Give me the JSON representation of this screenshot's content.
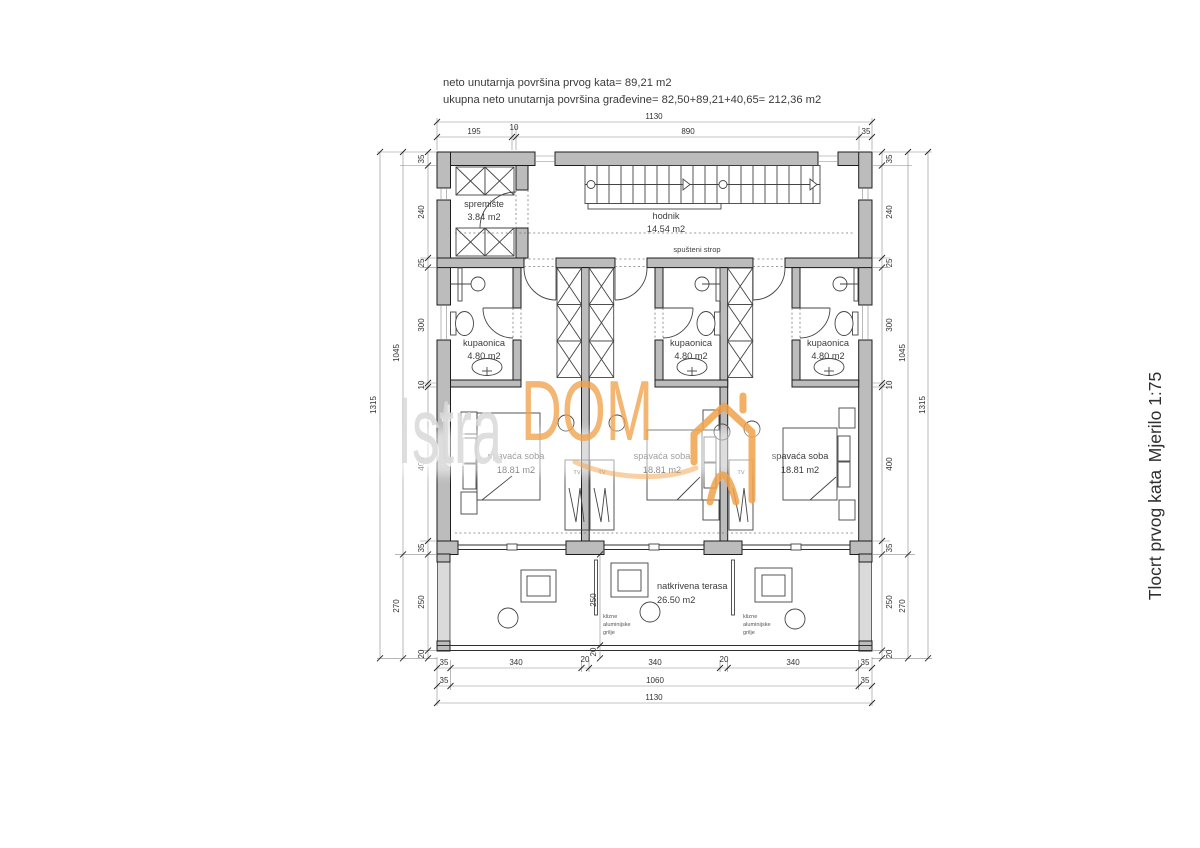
{
  "header": {
    "line1": "neto unutarnja površina prvog kata= 89,21 m2",
    "line2": "ukupna neto unutarnja površina građevine= 82,50+89,21+40,65= 212,36 m2"
  },
  "side": {
    "title": "Tlocrt prvog kata",
    "scale": "Mjerilo 1:75"
  },
  "watermark": {
    "brand1": "Istra",
    "brand2": "DOM"
  },
  "rooms": {
    "spremiste": {
      "name": "spremište",
      "area": "3.84 m2"
    },
    "hodnik": {
      "name": "hodnik",
      "area": "14.54 m2"
    },
    "kupaonica": {
      "name": "kupaonica",
      "area": "4.80 m2"
    },
    "spavaca": {
      "name": "spavaća soba",
      "area": "18.81 m2"
    },
    "terasa": {
      "name": "natkrivena terasa",
      "area": "26.50 m2"
    }
  },
  "notes": {
    "strop": "spušteni strop",
    "grilje": [
      "klizne",
      "aluminijske",
      "grilje"
    ],
    "tv": "TV"
  },
  "dims": {
    "top_total": "1130",
    "top_chain": [
      "195",
      "10",
      "890",
      "35"
    ],
    "bottom_chain": [
      "35",
      "340",
      "20",
      "340",
      "20",
      "340",
      "35"
    ],
    "bottom_mid": [
      "35",
      "1060",
      "35"
    ],
    "bottom_total": "1130",
    "side_chain": [
      "35",
      "240",
      "25",
      "300",
      "10",
      "400",
      "35",
      "250",
      "20"
    ],
    "side_mid": [
      "1045",
      "270"
    ],
    "side_total": "1315",
    "terrace_depth": "250",
    "terrace_edge": "20"
  },
  "colors": {
    "wall": "#bcbcbc",
    "shutter": "#dadada",
    "accent_orange": "#f0a24c",
    "watermark_gray": "#d9d9d9"
  }
}
